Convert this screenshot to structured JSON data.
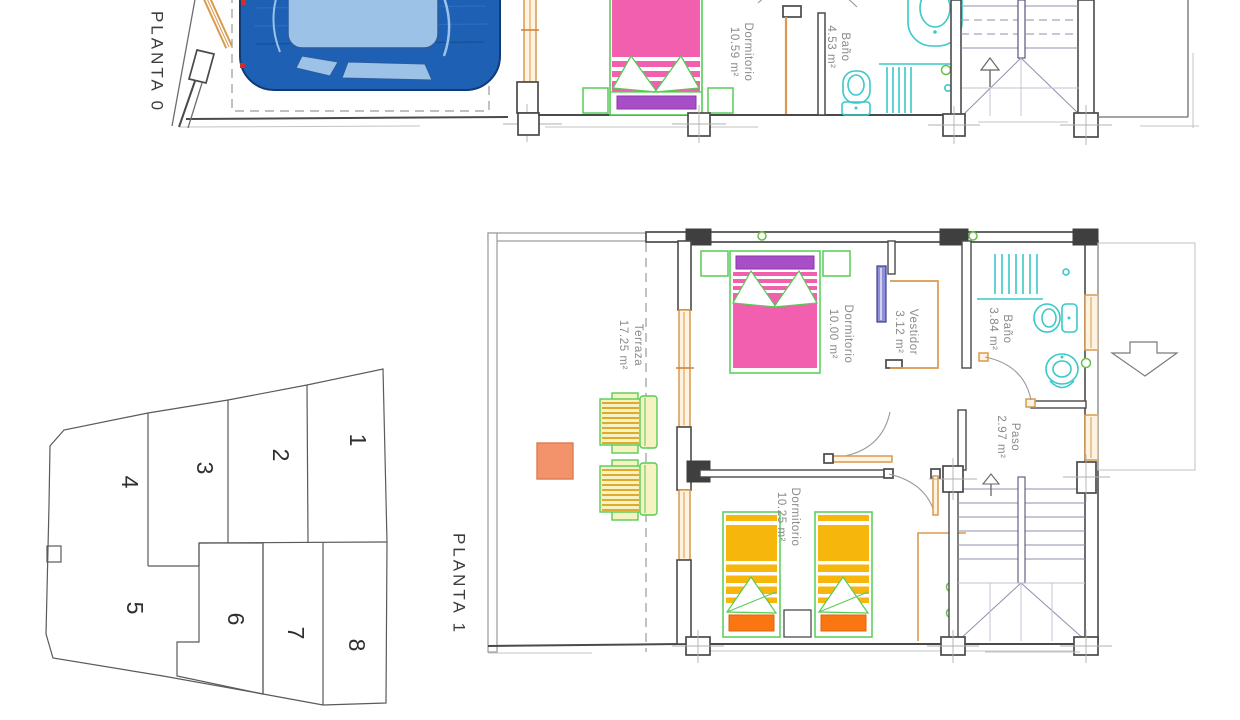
{
  "plan": {
    "floor0": {
      "title": "PLANTA 0",
      "rooms": {
        "dormitorio": {
          "name": "Dormitorio",
          "area": "10.59 m²"
        },
        "bano": {
          "name": "Baño",
          "area": "4.53 m²"
        }
      }
    },
    "floor1": {
      "title": "PLANTA 1",
      "rooms": {
        "terraza": {
          "name": "Terraza",
          "area": "17.25 m²"
        },
        "dormitorio1": {
          "name": "Dormitorio",
          "area": "10.00 m²"
        },
        "vestidor": {
          "name": "Vestidor",
          "area": "3.12 m²"
        },
        "bano": {
          "name": "Baño",
          "area": "3.84 m²"
        },
        "paso": {
          "name": "Paso",
          "area": "2.97 m²"
        },
        "dormitorio2": {
          "name": "Dormitorio",
          "area": "10.25 m²"
        }
      }
    },
    "parcel": {
      "lots": [
        "1",
        "2",
        "3",
        "4",
        "5",
        "6",
        "7",
        "8"
      ],
      "hatched_lot": "6"
    },
    "colors": {
      "wall": "#4a4a4a",
      "window_frame": "#d99a4e",
      "fixture_cyan": "#3bc8c8",
      "bed_pink": "#f25fae",
      "pillow_purple": "#a84fc8",
      "bed_yellow": "#f6b60b",
      "pillow_orange": "#f97613",
      "furniture_green": "#57cc57",
      "car_blue": "#1d60b4",
      "table_salmon": "#f2936b"
    }
  }
}
